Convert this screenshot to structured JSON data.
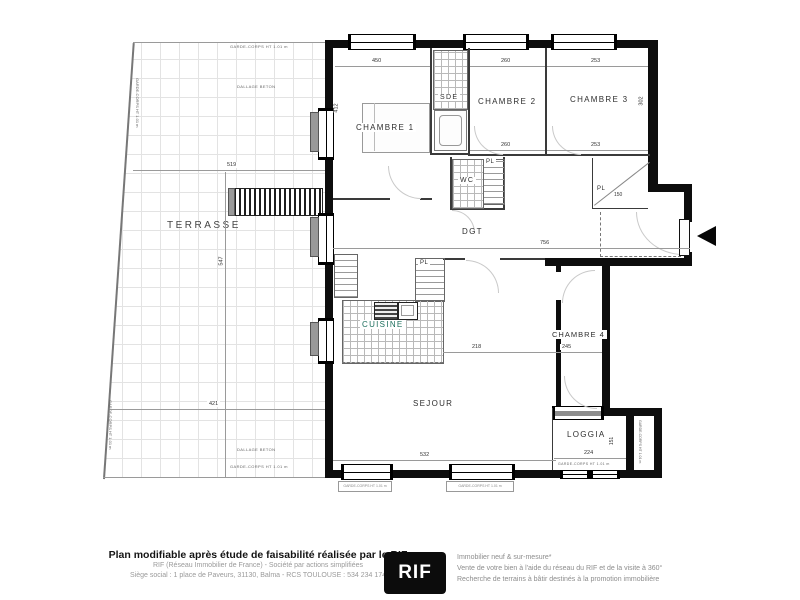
{
  "plan": {
    "rooms": {
      "terrasse": "TERRASSE",
      "chambre1": "CHAMBRE 1",
      "sde": "SDE",
      "chambre2": "CHAMBRE 2",
      "chambre3": "CHAMBRE 3",
      "wc": "WC",
      "pl": "PL",
      "dgt": "DGT",
      "cuisine": "CUISINE",
      "sejour": "SEJOUR",
      "chambre4": "CHAMBRE 4",
      "loggia": "LOGGIA"
    },
    "annotations": {
      "garde_corps": "GARDE-CORPS HT 1.01 m",
      "dallage": "DALLAGE BETON"
    },
    "dims": {
      "t_top": "519",
      "t_bottom": "421",
      "t_v": "547",
      "c1_top": "450",
      "c1_left": "412",
      "c2": "260",
      "c3": "253",
      "c3_right": "302",
      "dgt": "756",
      "pl_entry": "150",
      "sejour_top": "218",
      "c4": "245",
      "sejour_bottom": "532",
      "loggia": "224",
      "loggia_right": "151"
    }
  },
  "footer": {
    "title": "Plan modifiable après étude de faisabilité réalisée par le RIF",
    "line2": "RIF (Réseau Immobilier de France) - Société par actions simplifiées",
    "line3": "Siège social : 1 place de Paveurs, 31130, Balma - RCS TOULOUSE : 534 234 174",
    "logo": "RIF",
    "right1": "Immobilier neuf & sur-mesure*",
    "right2": "Vente de votre bien à l'aide du réseau du RIF et de la visite à 360°",
    "right3": "Recherche de terrains à bâtir destinés à la promotion immobilière"
  }
}
